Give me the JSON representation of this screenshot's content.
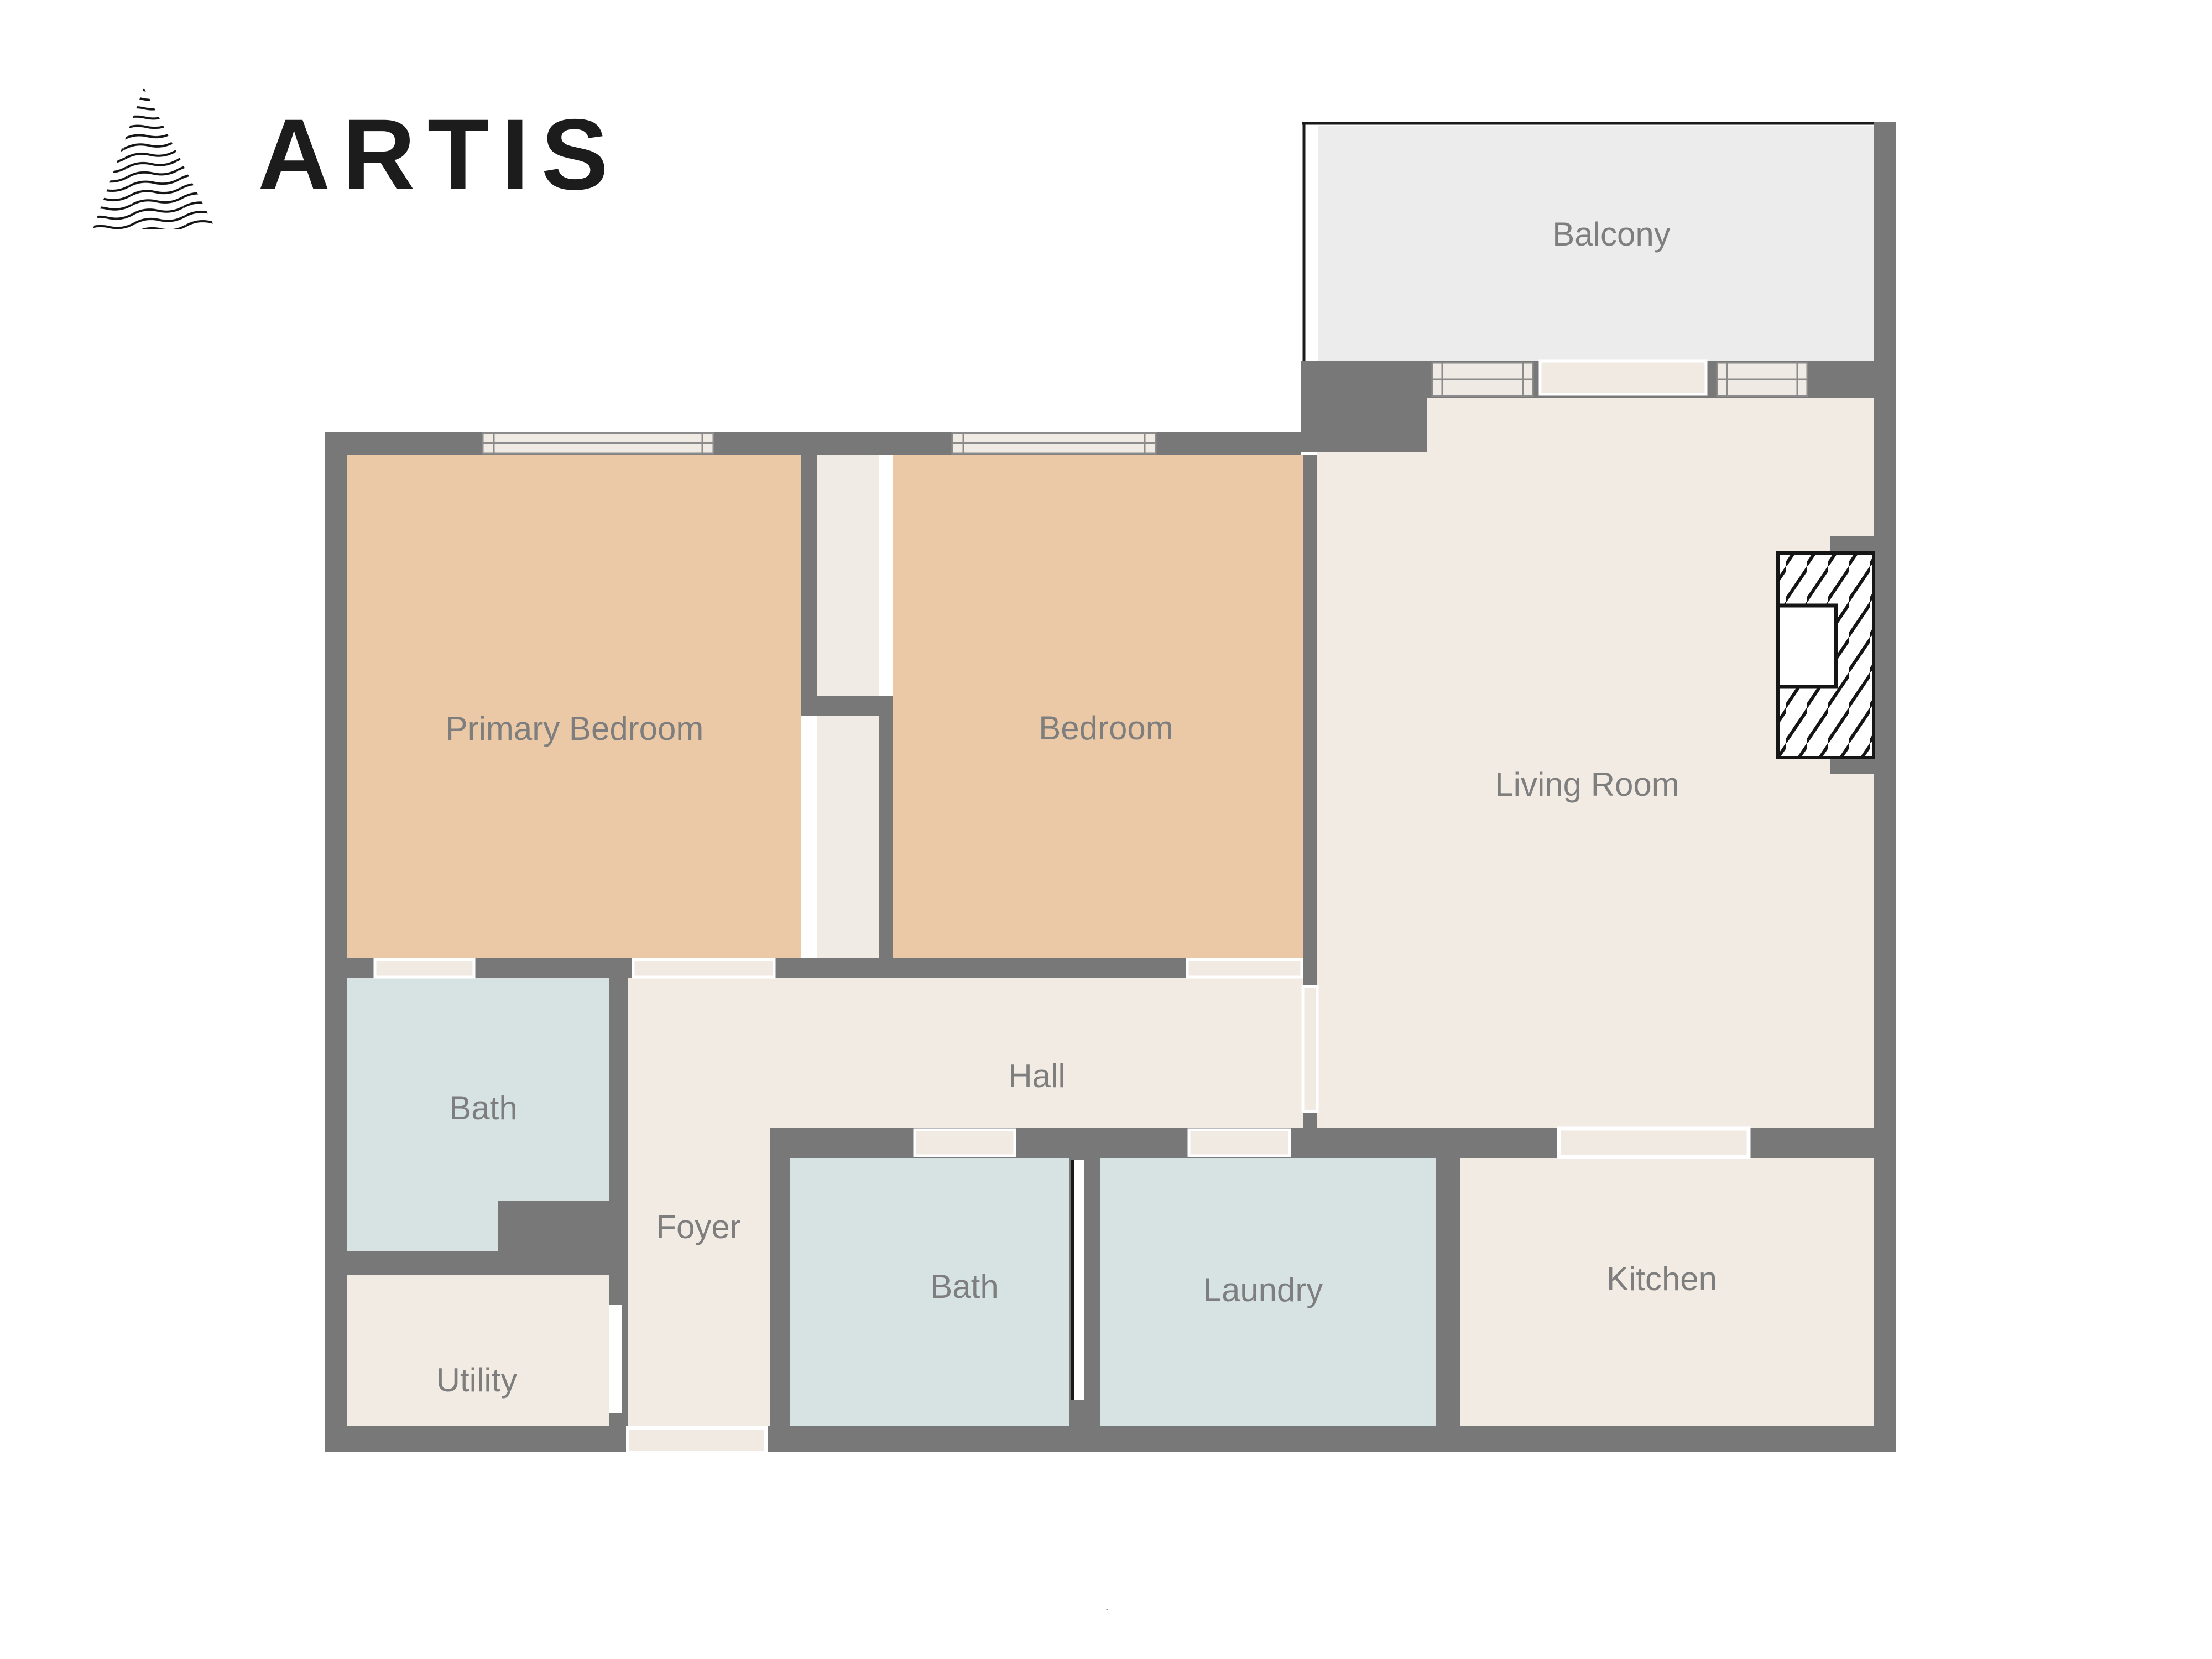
{
  "brand": {
    "name": "ARTIS"
  },
  "floorplan": {
    "rooms": [
      {
        "id": "balcony",
        "label": "Balcony"
      },
      {
        "id": "primary-bedroom",
        "label": "Primary Bedroom"
      },
      {
        "id": "bedroom",
        "label": "Bedroom"
      },
      {
        "id": "living-room",
        "label": "Living Room"
      },
      {
        "id": "hall",
        "label": "Hall"
      },
      {
        "id": "bath-ensuite",
        "label": "Bath"
      },
      {
        "id": "foyer",
        "label": "Foyer"
      },
      {
        "id": "utility",
        "label": "Utility"
      },
      {
        "id": "bath",
        "label": "Bath"
      },
      {
        "id": "laundry",
        "label": "Laundry"
      },
      {
        "id": "kitchen",
        "label": "Kitchen"
      }
    ],
    "colors": {
      "wall": "#787878",
      "floor": "#f2ebe4",
      "bedroom_floor": "#ebc9a6",
      "bath_floor": "#d6e3e2",
      "balcony_floor": "#ececec",
      "window_fill": "#f0eae4",
      "door_gap": "#f1eae3",
      "label_text": "#7e7e7e",
      "railing": "#1a1a1a",
      "logo_text": "#1c1c1c"
    },
    "footnote": "."
  }
}
